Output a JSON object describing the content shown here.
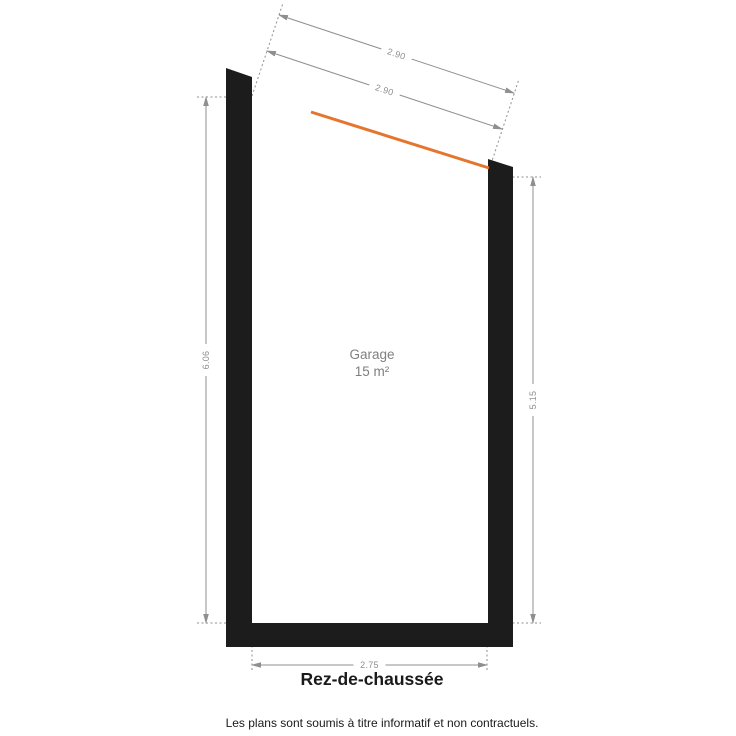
{
  "plan": {
    "room_label": "Garage",
    "room_area": "15 m²",
    "floor_title": "Rez-de-chaussée",
    "disclaimer": "Les plans sont soumis à titre informatif et non contractuels.",
    "dimensions": {
      "top_outer": "2.90",
      "top_inner": "2.90",
      "left_height": "6.06",
      "right_height": "5.15",
      "bottom_width": "2.75"
    },
    "colors": {
      "wall": "#1c1c1c",
      "dim": "#8f8f8f",
      "accent": "#e5752d",
      "room": "#7f7f7f",
      "text": "#1a1a1a"
    }
  }
}
